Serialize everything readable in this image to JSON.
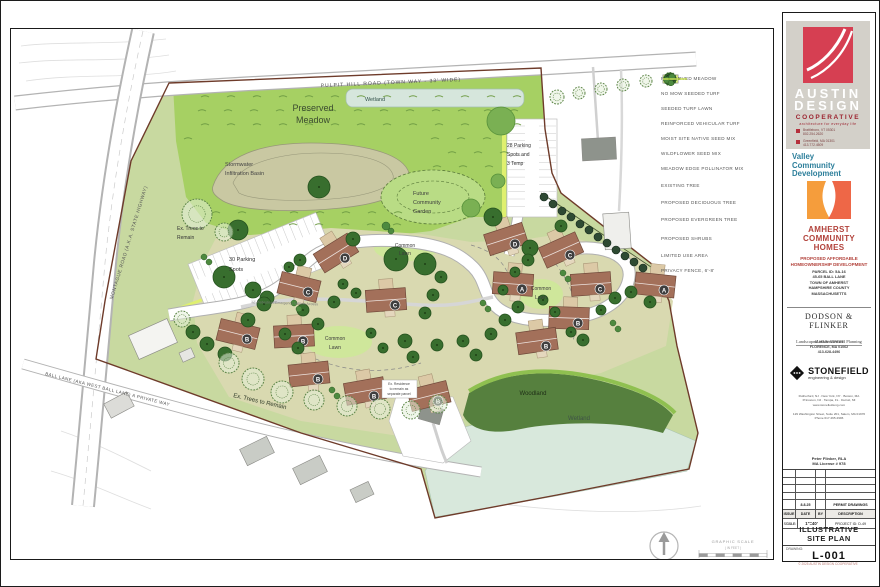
{
  "plan": {
    "labels": {
      "pulpit": "PULPIT HILL ROAD (TOWN WAY - 33' WIDE)",
      "montague": "MONTAGUE ROAD (A.K.A. STATE HIGHWAY)",
      "ball": "BALL LANE (AKA WEST BALL LANE) A PRIVATE WAY",
      "wetland_top": "Wetland",
      "wetland_bottom": "Wetland",
      "woodland": "Woodland",
      "preserved_1": "Preserved",
      "preserved_2": "Meadow",
      "stormwater_1": "Stormwater",
      "stormwater_2": "Infiltration Basin",
      "parking28_1": "28 Parking",
      "parking28_2": "Spots and",
      "parking28_3": "3 Temp",
      "garden_1": "Future",
      "garden_2": "Community",
      "garden_3": "Garden",
      "extrees_1": "Ex. Trees to",
      "extrees_2": "Remain",
      "extrees_bottom": "Ex. Trees to Remain",
      "parking30_1": "30 Parking",
      "parking30_2": "Spots",
      "common_1": "Common",
      "common_2": "Lawn",
      "ped": "12' Pedestrian/Emergency Vehicle Access",
      "exres_1": "Ex. Residence",
      "exres_2": "to remain as",
      "exres_3": "separate parcel",
      "graphic_scale": "GRAPHIC SCALE",
      "in_feet": "( IN FEET )"
    },
    "houses": [
      {
        "x": 335,
        "y": 252,
        "rot": -32,
        "letter": "D"
      },
      {
        "x": 298,
        "y": 286,
        "rot": 14,
        "letter": "C"
      },
      {
        "x": 385,
        "y": 299,
        "rot": -4,
        "letter": "C"
      },
      {
        "x": 237,
        "y": 333,
        "rot": 14,
        "letter": "B"
      },
      {
        "x": 293,
        "y": 335,
        "rot": -3,
        "letter": "B"
      },
      {
        "x": 308,
        "y": 373,
        "rot": -6,
        "letter": "B"
      },
      {
        "x": 364,
        "y": 390,
        "rot": -10,
        "letter": "B"
      },
      {
        "x": 428,
        "y": 395,
        "rot": -14,
        "letter": "B"
      },
      {
        "x": 505,
        "y": 238,
        "rot": -18,
        "letter": "D"
      },
      {
        "x": 560,
        "y": 249,
        "rot": -24,
        "letter": "C"
      },
      {
        "x": 512,
        "y": 283,
        "rot": 4,
        "letter": "A"
      },
      {
        "x": 590,
        "y": 283,
        "rot": -4,
        "letter": "C"
      },
      {
        "x": 568,
        "y": 317,
        "rot": 2,
        "letter": "B"
      },
      {
        "x": 536,
        "y": 340,
        "rot": -8,
        "letter": "B"
      },
      {
        "x": 654,
        "y": 284,
        "rot": 6,
        "letter": "A"
      }
    ],
    "buildings": [
      {
        "x": 598,
        "y": 148,
        "rot": -3,
        "w": 34,
        "h": 22,
        "f": "#8e938c"
      },
      {
        "x": 616,
        "y": 230,
        "rot": -4,
        "w": 26,
        "h": 36,
        "f": "#efefec"
      },
      {
        "x": 152,
        "y": 338,
        "rot": -24,
        "w": 42,
        "h": 26,
        "f": "#f4f4f1"
      },
      {
        "x": 186,
        "y": 354,
        "rot": -24,
        "w": 13,
        "h": 10,
        "f": "#e6e6e2"
      },
      {
        "x": 118,
        "y": 404,
        "rot": -28,
        "w": 26,
        "h": 16,
        "f": "#dcdcd8"
      },
      {
        "x": 256,
        "y": 450,
        "rot": -26,
        "w": 30,
        "h": 18,
        "f": "#c9ccc6"
      },
      {
        "x": 309,
        "y": 469,
        "rot": -26,
        "w": 30,
        "h": 18,
        "f": "#c9ccc6"
      },
      {
        "x": 361,
        "y": 491,
        "rot": -25,
        "w": 20,
        "h": 14,
        "f": "#c9ccc6"
      },
      {
        "x": 430,
        "y": 413,
        "rot": 16,
        "w": 22,
        "h": 16,
        "f": "#8e938c"
      }
    ],
    "trees": [
      [
        500,
        120,
        14,
        "l"
      ],
      [
        470,
        207,
        9,
        "l"
      ],
      [
        497,
        180,
        7,
        "l"
      ],
      [
        492,
        216,
        9,
        "d"
      ],
      [
        529,
        247,
        8,
        "d"
      ],
      [
        560,
        225,
        6,
        "d"
      ],
      [
        318,
        186,
        11,
        "d"
      ],
      [
        237,
        229,
        10,
        "d"
      ],
      [
        223,
        276,
        11,
        "d"
      ],
      [
        252,
        289,
        8,
        "d"
      ],
      [
        266,
        297,
        7,
        "d"
      ],
      [
        395,
        258,
        12,
        "d"
      ],
      [
        424,
        263,
        11,
        "d"
      ],
      [
        352,
        238,
        7,
        "d"
      ],
      [
        440,
        276,
        6,
        "d"
      ],
      [
        432,
        294,
        6,
        "d"
      ],
      [
        424,
        312,
        6,
        "d"
      ],
      [
        404,
        340,
        7,
        "d"
      ],
      [
        412,
        356,
        6,
        "d"
      ],
      [
        436,
        344,
        6,
        "d"
      ],
      [
        302,
        309,
        6,
        "d"
      ],
      [
        317,
        323,
        6,
        "d"
      ],
      [
        333,
        301,
        6,
        "d"
      ],
      [
        284,
        333,
        6,
        "d"
      ],
      [
        297,
        347,
        6,
        "d"
      ],
      [
        263,
        303,
        7,
        "d"
      ],
      [
        247,
        319,
        7,
        "d"
      ],
      [
        206,
        343,
        7,
        "d"
      ],
      [
        192,
        331,
        7,
        "d"
      ],
      [
        224,
        353,
        7,
        "d"
      ],
      [
        462,
        340,
        6,
        "d"
      ],
      [
        475,
        354,
        6,
        "d"
      ],
      [
        490,
        333,
        6,
        "d"
      ],
      [
        504,
        319,
        6,
        "d"
      ],
      [
        517,
        306,
        6,
        "d"
      ],
      [
        502,
        289,
        5,
        "d"
      ],
      [
        514,
        271,
        5,
        "d"
      ],
      [
        527,
        259,
        6,
        "d"
      ],
      [
        542,
        299,
        5,
        "d"
      ],
      [
        554,
        311,
        5,
        "d"
      ],
      [
        570,
        331,
        5,
        "d"
      ],
      [
        582,
        339,
        6,
        "d"
      ],
      [
        600,
        309,
        5,
        "d"
      ],
      [
        614,
        297,
        6,
        "d"
      ],
      [
        630,
        291,
        6,
        "d"
      ],
      [
        649,
        301,
        6,
        "d"
      ],
      [
        342,
        283,
        5,
        "d"
      ],
      [
        355,
        292,
        5,
        "d"
      ],
      [
        370,
        332,
        5,
        "d"
      ],
      [
        382,
        347,
        5,
        "d"
      ],
      [
        299,
        259,
        6,
        "d"
      ],
      [
        288,
        266,
        5,
        "d"
      ],
      [
        196,
        213,
        15,
        "x"
      ],
      [
        223,
        231,
        9,
        "x"
      ],
      [
        181,
        318,
        8,
        "x"
      ],
      [
        228,
        362,
        10,
        "x"
      ],
      [
        252,
        378,
        11,
        "x"
      ],
      [
        281,
        391,
        11,
        "x"
      ],
      [
        313,
        399,
        10,
        "x"
      ],
      [
        346,
        405,
        10,
        "x"
      ],
      [
        379,
        408,
        10,
        "x"
      ],
      [
        410,
        409,
        9,
        "x"
      ],
      [
        437,
        403,
        9,
        "x"
      ],
      [
        556,
        96,
        7,
        "x"
      ],
      [
        578,
        92,
        6,
        "x"
      ],
      [
        600,
        88,
        6,
        "x"
      ],
      [
        622,
        84,
        6,
        "x"
      ],
      [
        645,
        80,
        6,
        "x"
      ],
      [
        543,
        196,
        4,
        "e"
      ],
      [
        552,
        203,
        4,
        "e"
      ],
      [
        561,
        210,
        4,
        "e"
      ],
      [
        570,
        216,
        4,
        "e"
      ],
      [
        579,
        223,
        4,
        "e"
      ],
      [
        588,
        229,
        4,
        "e"
      ],
      [
        597,
        236,
        4,
        "e"
      ],
      [
        606,
        242,
        4,
        "e"
      ],
      [
        615,
        249,
        4,
        "e"
      ],
      [
        624,
        255,
        4,
        "e"
      ],
      [
        633,
        261,
        4,
        "e"
      ],
      [
        642,
        267,
        4,
        "e"
      ],
      [
        293,
        302,
        3,
        "s"
      ],
      [
        298,
        308,
        3,
        "s"
      ],
      [
        482,
        302,
        3,
        "s"
      ],
      [
        487,
        308,
        3,
        "s"
      ],
      [
        562,
        272,
        3,
        "s"
      ],
      [
        567,
        278,
        3,
        "s"
      ],
      [
        612,
        322,
        3,
        "s"
      ],
      [
        617,
        328,
        3,
        "s"
      ],
      [
        331,
        389,
        3,
        "s"
      ],
      [
        336,
        395,
        3,
        "s"
      ],
      [
        203,
        256,
        3,
        "s"
      ],
      [
        208,
        261,
        3,
        "s"
      ],
      [
        385,
        225,
        4,
        "s"
      ],
      [
        390,
        230,
        3,
        "s"
      ]
    ],
    "colors": {
      "meadow": "#a6d063",
      "meadow_dash": "#6f9c44",
      "cluster": "#d9d9b0",
      "woodland": "#56803e",
      "wetland": "#d8e8dc",
      "basin": "#c9c8a2",
      "lawn": "#cfe79b",
      "boundary": "#6e3b2a",
      "roof": "#a3705a",
      "roof_stroke": "#70493a",
      "porch": "#dcc9a6",
      "badge": "#3e3e3e",
      "tree_d": "#386e2e",
      "tree_d_stroke": "#25511e",
      "tree_l": "#7ab053",
      "tree_l_stroke": "#57913b",
      "tree_e": "#2e4a33",
      "tree_x_stroke": "#5c8547",
      "shrub": "#4d8a3f",
      "pollinator": "#dff06f"
    }
  },
  "legend": {
    "items": [
      {
        "kind": "fill",
        "color": "#a6d063",
        "label": "PRESERVED MEADOW"
      },
      {
        "kind": "fill",
        "color": "#cbcba1",
        "label": "NO MOW SEEDED TURF"
      },
      {
        "kind": "fill",
        "color": "#b8d977",
        "label": "SEEDED TURF LAWN"
      },
      {
        "kind": "fill",
        "color": "#d4d4d4",
        "label": "REINFORCED VEHICULAR TURF"
      },
      {
        "kind": "fill",
        "color": "#c4dba6",
        "label": "MOIST SITE NATIVE SEED MIX"
      },
      {
        "kind": "fill",
        "color": "#cfe49b",
        "label": "WILDFLOWER SEED MIX"
      },
      {
        "kind": "fill",
        "color": "#e0f079",
        "label": "MEADOW EDGE POLLINATOR MIX"
      },
      {
        "kind": "existing-tree",
        "label": "EXISTING TREE"
      },
      {
        "kind": "deciduous-tree",
        "label": "PROPOSED DECIDUOUS TREE"
      },
      {
        "kind": "evergreen-tree",
        "label": "PROPOSED EVERGREEN TREE"
      },
      {
        "kind": "shrubs",
        "label": "PROPOSED SHRUBS"
      },
      {
        "kind": "dash-line",
        "label": "LIMITED USE AREA"
      },
      {
        "kind": "fence-line",
        "label": "PRIVACY FENCE, 6'-8'"
      }
    ]
  },
  "titleblock": {
    "austin": {
      "line1": "AUSTIN",
      "line2": "DESIGN",
      "line3": "COOPERATIVE",
      "tagline": "architecture for everyday life",
      "offices": [
        {
          "city": "Brattleboro, VT 05301",
          "phone": "802.254.2620"
        },
        {
          "city": "Greenfield, MA 01301",
          "phone": "413.772.4509"
        }
      ]
    },
    "valley": {
      "l1": "Valley",
      "l2": "Community",
      "l3": "Development"
    },
    "project": {
      "name1": "AMHERST",
      "name2": "COMMUNITY",
      "name3": "HOMES",
      "sub1": "PROPOSED AFFORDABLE",
      "sub2": "HOMEOWNERSHIP DEVELOPMENT",
      "info": [
        "PARCEL ID: 5A-16",
        "45-65 BALL LANE",
        "TOWN OF AMHERST",
        "HAMPSHIRE COUNTY",
        "MASSACHUSETTS"
      ]
    },
    "dodson": {
      "name": "DODSON & FLINKER",
      "sub": "Landscape Architecture and Planning",
      "addr": [
        "40 MAIN STREET",
        "FLORENCE, MA 01062",
        "413-628-4496"
      ]
    },
    "stonefield": {
      "name": "STONEFIELD",
      "sub": "engineering & design",
      "offices": [
        "Rutherford, NJ  ·  New York, NY  ·  Boston, MA",
        "Princeton, NJ  ·  Tampa, FL  ·  Detroit, MI",
        "www.stonefieldeng.com"
      ],
      "local": [
        "129 Washington Street, Suite 201, Salem, MA 01970",
        "Phone 617.265.2996"
      ]
    },
    "licensee": {
      "l1": "Peter Flinker, RLA",
      "l2": "MA License # 978"
    },
    "revisions": {
      "filled": {
        "issue": "",
        "date": "8.8.25",
        "by": "",
        "desc": "PERMIT DRAWINGS"
      },
      "headers": [
        "ISSUE",
        "DATE",
        "BY",
        "DESCRIPTION"
      ],
      "scale_label": "SCALE:",
      "scale_value": "1\"=40'",
      "project_id": "PROJECT ID: D-49"
    },
    "title_label": "TITLE:",
    "title_1": "ILLUSTRATIVE",
    "title_2": "SITE PLAN",
    "drawing_label": "DRAWING:",
    "number": "L-001",
    "copyright": "© 2025 AUSTIN DESIGN COOPERATIVE"
  }
}
